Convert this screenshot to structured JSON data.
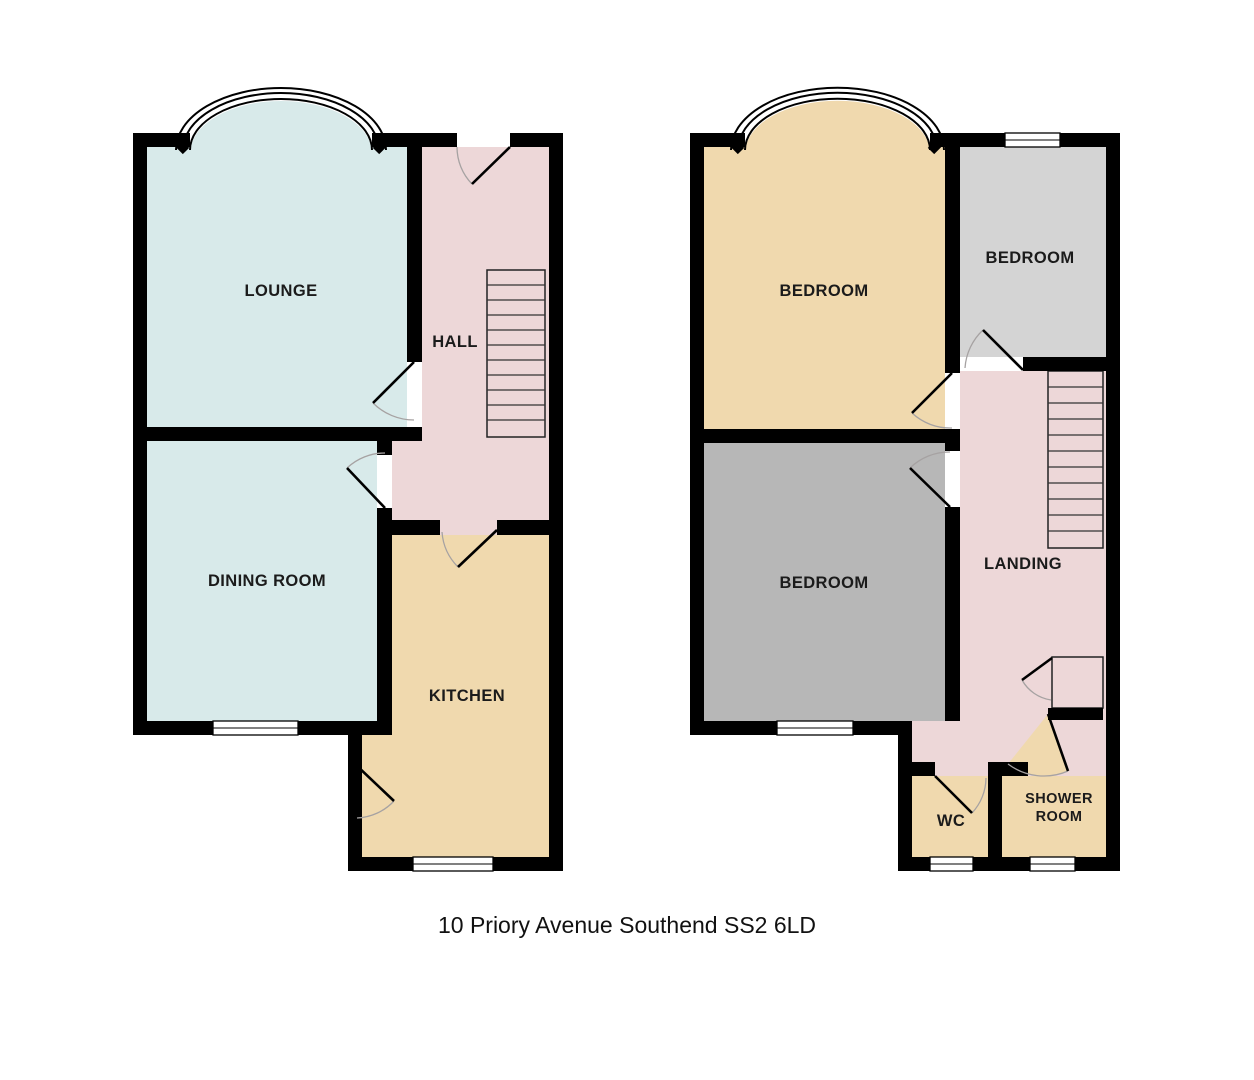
{
  "caption": "10 Priory Avenue Southend SS2 6LD",
  "colors": {
    "lounge_dining": "#d8eaea",
    "hall_landing": "#edd7d8",
    "kitchen_tan": "#f0d9ae",
    "bedroom_gray_light": "#d4d4d4",
    "bedroom_gray": "#b7b7b7"
  },
  "ground_floor": {
    "lounge": "LOUNGE",
    "hall": "HALL",
    "dining_room": "DINING ROOM",
    "kitchen": "KITCHEN"
  },
  "first_floor": {
    "bedroom_front": "BEDROOM",
    "bedroom_top": "BEDROOM",
    "bedroom_back": "BEDROOM",
    "landing": "LANDING",
    "wc": "WC",
    "shower_line1": "SHOWER",
    "shower_line2": "ROOM"
  }
}
